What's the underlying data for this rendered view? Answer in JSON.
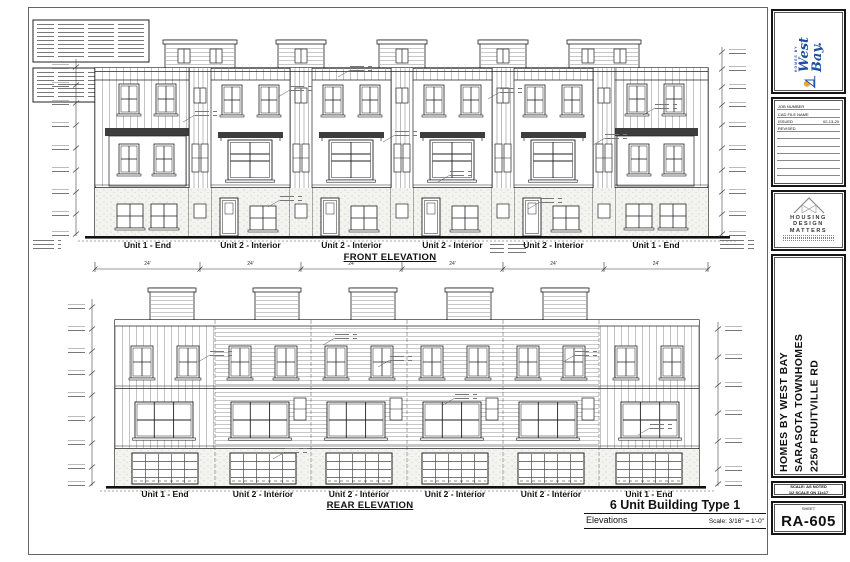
{
  "front": {
    "title": "FRONT ELEVATION",
    "unit_labels": [
      "Unit 1 - End",
      "Unit 2 - Interior",
      "Unit 2 - Interior",
      "Unit 2 - Interior",
      "Unit 2 - Interior",
      "Unit 1 - End"
    ],
    "dim_label": "24'"
  },
  "rear": {
    "title": "REAR ELEVATION",
    "unit_labels": [
      "Unit 1 - End",
      "Unit 2 - Interior",
      "Unit 2 - Interior",
      "Unit 2 - Interior",
      "Unit 2 - Interior",
      "Unit 1 - End"
    ]
  },
  "titlebar": {
    "title": "6 Unit Building Type 1",
    "sheet_type": "Elevations",
    "scale": "Scale: 3/16\" = 1'-0\""
  },
  "strip": {
    "westbay": {
      "tagline": "HOMES BY",
      "name": "West Bay."
    },
    "job": {
      "row1": "JOB NUMBER",
      "row2": "CAD FILE NAME",
      "row3": "ISSUED",
      "issued": "02-13-20",
      "row4": "REVISED"
    },
    "hdm": {
      "l1": "HOUSING",
      "l2": "DESIGN",
      "l3": "MATTERS"
    },
    "project": {
      "l1": "HOMES BY WEST BAY",
      "l2": "SARASOTA TOWNHOMES",
      "l3": "2250 FRUITVILLE RD"
    },
    "scalebox": {
      "l1": "SCALE: AS NOTED",
      "l2": "1/2 SCALE ON 11x17"
    },
    "sheetbox": {
      "label": "SHEET",
      "number": "RA-605"
    }
  },
  "colors": {
    "line": "#222222",
    "westbay_blue": "#1c4fa0",
    "westbay_orange": "#f0a22e"
  }
}
